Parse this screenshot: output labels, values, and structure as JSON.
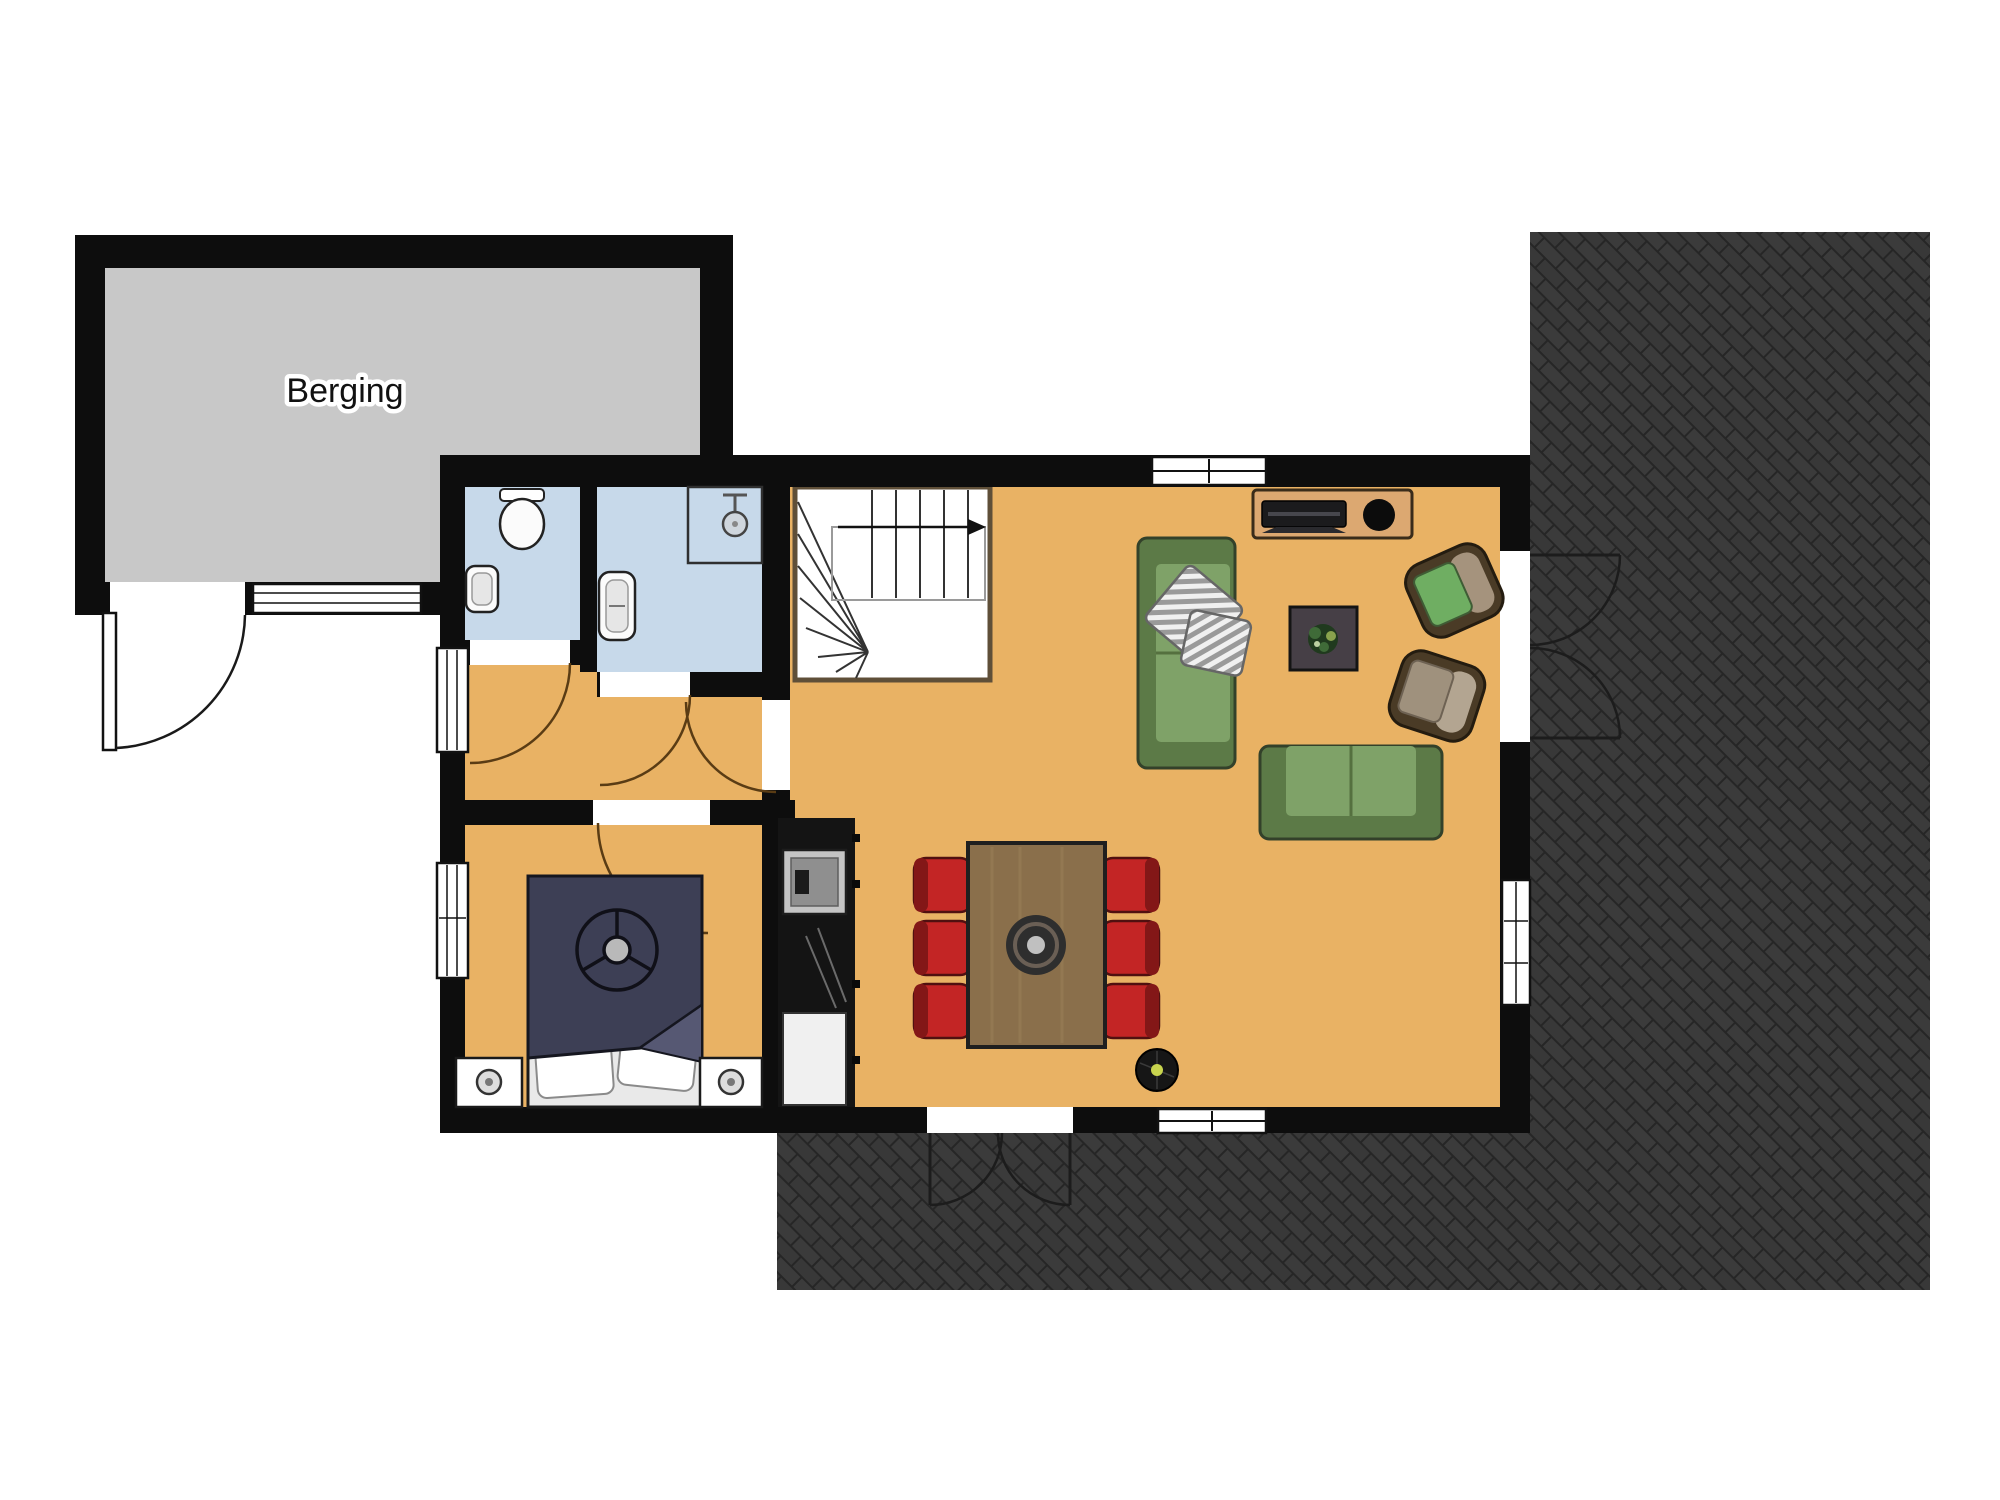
{
  "labels": {
    "storage_room": "Berging"
  },
  "colors": {
    "wall": "#0d0d0d",
    "floor_wood": "#e9b264",
    "floor_wet": "#c7d9ea",
    "floor_storage": "#c8c8c8",
    "patio_base": "#2f2f2f",
    "patio_brick": "#3b3b3b",
    "stairs_border": "#5f4f38",
    "sofa_green": "#7fa268",
    "sofa_green_dark": "#5c7a47",
    "cushion_green": "#6fae62",
    "chair_red": "#c32525",
    "chair_red_dark": "#831717",
    "table_wood": "#8a6f4b",
    "cabinet_wood": "#dca871",
    "bed_navy": "#3d3f55",
    "kitchen_black": "#141414",
    "accent_lamp": "#c8d44e"
  },
  "rooms": [
    {
      "key": "storage",
      "floor_color": "#c8c8c8"
    },
    {
      "key": "toilet",
      "floor_color": "#c7d9ea"
    },
    {
      "key": "bathroom",
      "floor_color": "#c7d9ea"
    },
    {
      "key": "hallway",
      "floor_color": "#e9b264"
    },
    {
      "key": "bedroom",
      "floor_color": "#e9b264"
    },
    {
      "key": "living-room",
      "floor_color": "#e9b264"
    },
    {
      "key": "patio",
      "floor_color": "#2f2f2f"
    }
  ],
  "furniture": [
    "staircase",
    "stairs-direction-arrow",
    "shower",
    "toilet",
    "hand-basin",
    "bathroom-sink",
    "kitchen-block",
    "stove",
    "refrigerator",
    "double-bed",
    "nightstand",
    "table-lamp",
    "dining-table",
    "dining-chair",
    "table-centerpiece",
    "robot-vacuum",
    "sofa",
    "striped-pillow",
    "armchair",
    "tv-cabinet",
    "tv",
    "speaker",
    "coffee-table",
    "plant"
  ]
}
